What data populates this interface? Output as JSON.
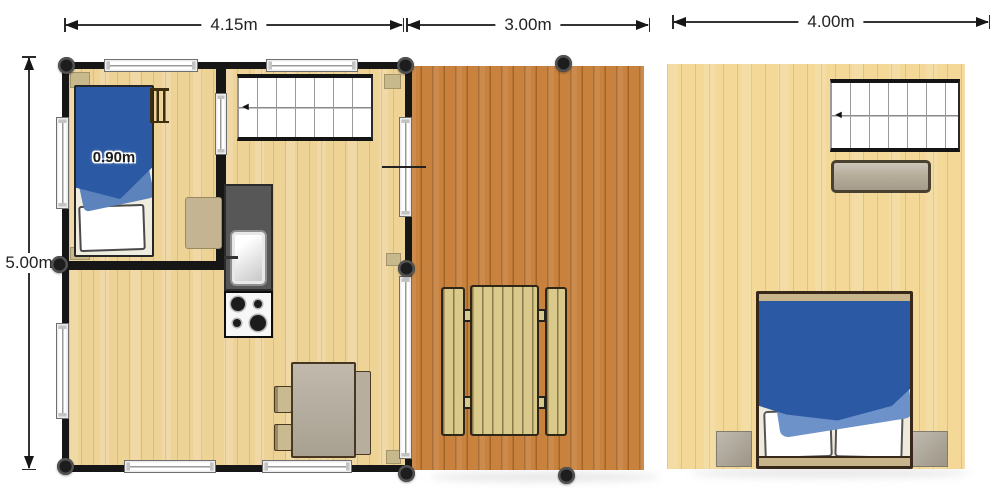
{
  "diagram": {
    "type": "floor-plan",
    "labels": {
      "cabin_width": "4.15m",
      "deck_width": "3.00m",
      "loft_width": "4.00m",
      "cabin_depth": "5.00m",
      "single_bed_width": "0.90m"
    },
    "glyphs": {
      "stair_direction_arrow": "◄"
    },
    "colors": {
      "wall": "#161616",
      "cabin_floor": "#eed397",
      "deck_floor": "#c8823e",
      "loft_floor": "#f3d897",
      "blanket_blue": "#2b59a3",
      "blanket_fold_blue": "#6d92c9",
      "picnic_wood": "#d9c98a",
      "table_gray": "#b3aa9a",
      "counter_gray": "#575757"
    }
  }
}
